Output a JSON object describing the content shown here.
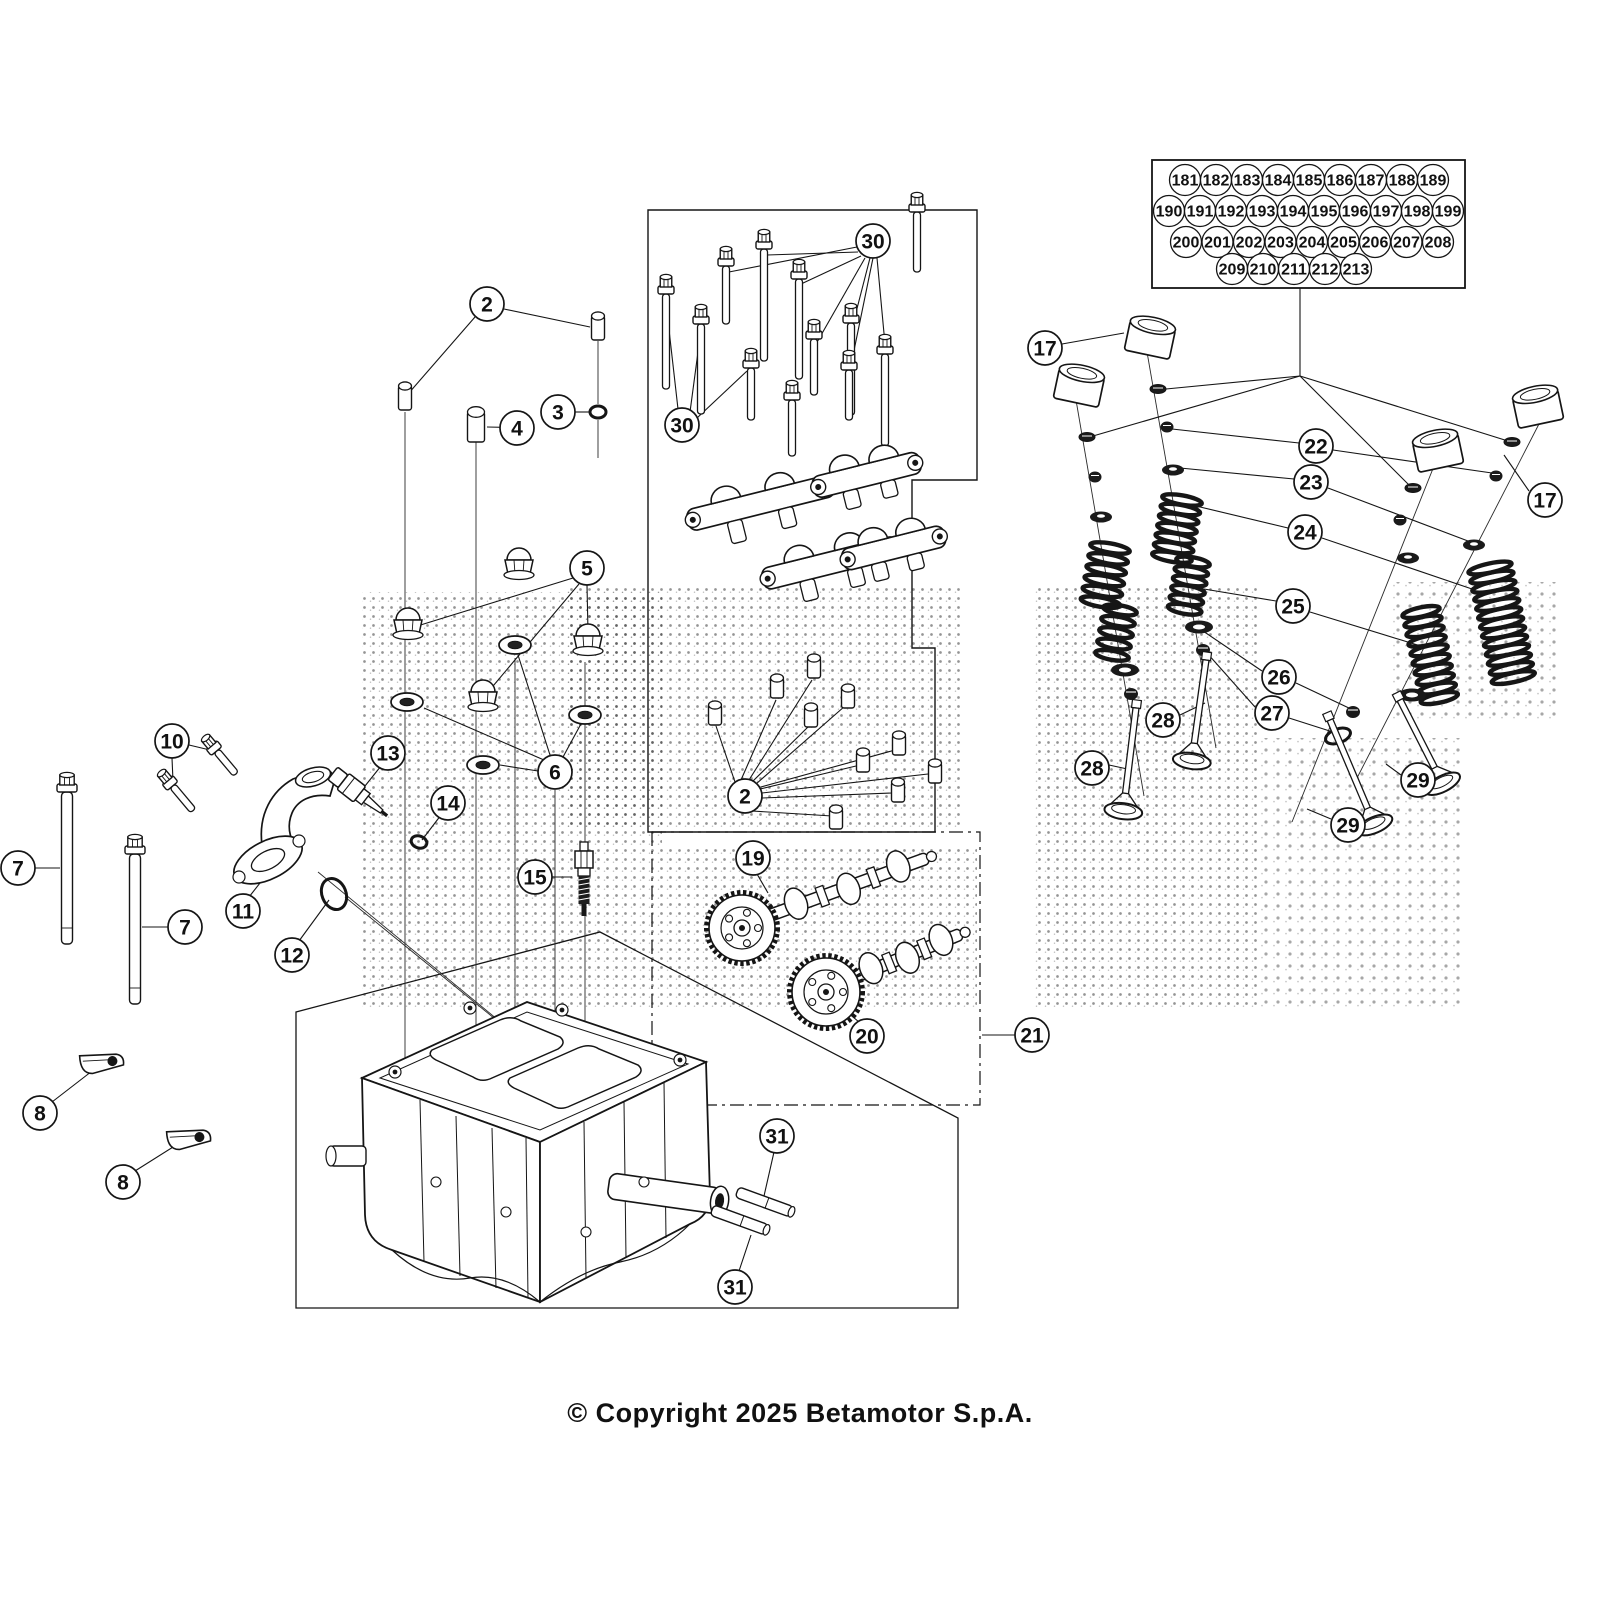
{
  "meta": {
    "copyright": "© Copyright 2025 Betamotor S.p.A."
  },
  "colors": {
    "ink": "#151515",
    "bg": "#ffffff",
    "dot": "#3c3c3c"
  },
  "grid_box": {
    "x": 1152,
    "y": 160,
    "w": 313,
    "h": 128,
    "rows": [
      {
        "y": 180,
        "x0": 1185,
        "step": 31,
        "labels": [
          "181",
          "182",
          "183",
          "184",
          "185",
          "186",
          "187",
          "188",
          "189"
        ]
      },
      {
        "y": 211,
        "x0": 1169,
        "step": 31,
        "labels": [
          "190",
          "191",
          "192",
          "193",
          "194",
          "195",
          "196",
          "197",
          "198",
          "199"
        ]
      },
      {
        "y": 242,
        "x0": 1186,
        "step": 31.5,
        "labels": [
          "200",
          "201",
          "202",
          "203",
          "204",
          "205",
          "206",
          "207",
          "208"
        ]
      },
      {
        "y": 269,
        "x0": 1232,
        "step": 31,
        "labels": [
          "209",
          "210",
          "211",
          "212",
          "213"
        ]
      }
    ],
    "leader_stem": [
      1300,
      288,
      1300,
      376
    ],
    "fan": [
      [
        1300,
        376,
        1166,
        389
      ],
      [
        1300,
        376,
        1093,
        436
      ],
      [
        1300,
        376,
        1508,
        441
      ],
      [
        1300,
        376,
        1410,
        486
      ]
    ]
  },
  "callouts": [
    {
      "label": "2",
      "x": 487,
      "y": 304
    },
    {
      "label": "2",
      "x": 745,
      "y": 796
    },
    {
      "label": "3",
      "x": 558,
      "y": 412
    },
    {
      "label": "4",
      "x": 517,
      "y": 428
    },
    {
      "label": "5",
      "x": 587,
      "y": 568
    },
    {
      "label": "6",
      "x": 555,
      "y": 772
    },
    {
      "label": "7",
      "x": 18,
      "y": 868
    },
    {
      "label": "7",
      "x": 185,
      "y": 927
    },
    {
      "label": "8",
      "x": 40,
      "y": 1113
    },
    {
      "label": "8",
      "x": 123,
      "y": 1182
    },
    {
      "label": "10",
      "x": 172,
      "y": 741
    },
    {
      "label": "11",
      "x": 243,
      "y": 911
    },
    {
      "label": "12",
      "x": 292,
      "y": 955
    },
    {
      "label": "13",
      "x": 388,
      "y": 753
    },
    {
      "label": "14",
      "x": 448,
      "y": 803
    },
    {
      "label": "15",
      "x": 535,
      "y": 877
    },
    {
      "label": "17",
      "x": 1045,
      "y": 348
    },
    {
      "label": "17",
      "x": 1545,
      "y": 500
    },
    {
      "label": "19",
      "x": 753,
      "y": 858
    },
    {
      "label": "20",
      "x": 867,
      "y": 1036
    },
    {
      "label": "21",
      "x": 1032,
      "y": 1035
    },
    {
      "label": "22",
      "x": 1316,
      "y": 446
    },
    {
      "label": "23",
      "x": 1311,
      "y": 482
    },
    {
      "label": "24",
      "x": 1305,
      "y": 532
    },
    {
      "label": "25",
      "x": 1293,
      "y": 606
    },
    {
      "label": "26",
      "x": 1279,
      "y": 677
    },
    {
      "label": "27",
      "x": 1272,
      "y": 713
    },
    {
      "label": "28",
      "x": 1163,
      "y": 720
    },
    {
      "label": "28",
      "x": 1092,
      "y": 768
    },
    {
      "label": "29",
      "x": 1418,
      "y": 780
    },
    {
      "label": "29",
      "x": 1348,
      "y": 825
    },
    {
      "label": "30",
      "x": 873,
      "y": 241
    },
    {
      "label": "30",
      "x": 682,
      "y": 425
    },
    {
      "label": "31",
      "x": 777,
      "y": 1136
    },
    {
      "label": "31",
      "x": 735,
      "y": 1287
    }
  ],
  "leaders": [
    [
      504,
      309,
      590,
      327
    ],
    [
      475,
      317,
      408,
      394
    ],
    [
      575,
      412,
      589,
      412
    ],
    [
      534,
      428,
      487,
      427
    ],
    [
      573,
      578,
      414,
      627
    ],
    [
      579,
      584,
      488,
      692
    ],
    [
      587,
      585,
      588,
      632
    ],
    [
      544,
      760,
      424,
      708
    ],
    [
      550,
      755,
      518,
      655
    ],
    [
      538,
      771,
      500,
      765
    ],
    [
      563,
      757,
      582,
      722
    ],
    [
      35,
      868,
      60,
      868
    ],
    [
      168,
      927,
      142,
      927
    ],
    [
      52,
      1102,
      96,
      1068
    ],
    [
      135,
      1171,
      181,
      1142
    ],
    [
      189,
      745,
      210,
      750
    ],
    [
      172,
      758,
      173,
      781
    ],
    [
      249,
      897,
      271,
      869
    ],
    [
      299,
      941,
      329,
      900
    ],
    [
      381,
      766,
      365,
      786
    ],
    [
      441,
      815,
      422,
      840
    ],
    [
      552,
      877,
      572,
      877
    ],
    [
      1062,
      344,
      1124,
      333
    ],
    [
      1529,
      491,
      1504,
      455
    ],
    [
      757,
      874,
      768,
      893
    ],
    [
      859,
      1022,
      841,
      1007
    ],
    [
      1015,
      1035,
      982,
      1035
    ],
    [
      1299,
      443,
      1172,
      429
    ],
    [
      1333,
      450,
      1492,
      473
    ],
    [
      1294,
      479,
      1180,
      468
    ],
    [
      1328,
      488,
      1468,
      541
    ],
    [
      1288,
      528,
      1196,
      506
    ],
    [
      1322,
      538,
      1472,
      589
    ],
    [
      1276,
      601,
      1198,
      588
    ],
    [
      1310,
      612,
      1424,
      647
    ],
    [
      1262,
      671,
      1203,
      631
    ],
    [
      1296,
      683,
      1351,
      709
    ],
    [
      1255,
      707,
      1207,
      653
    ],
    [
      1289,
      718,
      1336,
      733
    ],
    [
      1180,
      715,
      1205,
      703
    ],
    [
      1109,
      765,
      1132,
      770
    ],
    [
      1401,
      775,
      1386,
      764
    ],
    [
      1331,
      819,
      1307,
      809
    ],
    [
      857,
      247,
      729,
      272
    ],
    [
      858,
      252,
      767,
      255
    ],
    [
      861,
      256,
      801,
      284
    ],
    [
      865,
      258,
      816,
      344
    ],
    [
      870,
      258,
      852,
      328
    ],
    [
      877,
      258,
      886,
      355
    ],
    [
      873,
      258,
      850,
      370
    ],
    [
      678,
      409,
      667,
      312
    ],
    [
      690,
      412,
      700,
      337
    ],
    [
      697,
      418,
      747,
      371
    ],
    [
      774,
      1152,
      764,
      1196
    ],
    [
      739,
      1271,
      751,
      1235
    ],
    [
      735,
      782,
      716,
      726
    ],
    [
      741,
      780,
      776,
      700
    ],
    [
      749,
      780,
      812,
      680
    ],
    [
      752,
      782,
      809,
      726
    ],
    [
      756,
      784,
      845,
      706
    ],
    [
      760,
      789,
      856,
      766
    ],
    [
      761,
      787,
      895,
      750
    ],
    [
      762,
      793,
      928,
      774
    ],
    [
      762,
      798,
      892,
      793
    ],
    [
      752,
      811,
      832,
      816
    ]
  ],
  "axis_lines": [
    [
      1147,
      352,
      1216,
      748
    ],
    [
      1076,
      400,
      1144,
      796
    ],
    [
      1434,
      466,
      1292,
      822
    ],
    [
      1540,
      422,
      1357,
      778
    ],
    [
      318,
      872,
      520,
      1038
    ],
    [
      345,
      897,
      548,
      1062
    ]
  ],
  "construction_lines": [
    [
      405,
      412,
      405,
      1058
    ],
    [
      476,
      442,
      476,
      1086
    ],
    [
      515,
      658,
      515,
      1096
    ],
    [
      555,
      790,
      555,
      1106
    ],
    [
      585,
      662,
      585,
      1118
    ],
    [
      598,
      341,
      598,
      404
    ],
    [
      598,
      420,
      598,
      458
    ]
  ],
  "boxes": {
    "parts_box": "M648,832 L648,210 L977,210 L977,480 L912,480 L912,648 L935,648 L935,832 Z",
    "cam_box": {
      "x": 652,
      "y": 832,
      "w": 328,
      "h": 273
    },
    "tilt_box": "M296,1012 L600,932 L958,1118 L958,1308 L296,1308 Z"
  },
  "watermark_patches": [
    {
      "x": 362,
      "y": 592,
      "w": 300,
      "h": 418,
      "d": "a"
    },
    {
      "x": 565,
      "y": 585,
      "w": 395,
      "h": 245,
      "d": "a"
    },
    {
      "x": 662,
      "y": 848,
      "w": 315,
      "h": 160,
      "d": "a"
    },
    {
      "x": 1035,
      "y": 585,
      "w": 225,
      "h": 425,
      "d": "a"
    },
    {
      "x": 1258,
      "y": 738,
      "w": 205,
      "h": 272,
      "d": "b"
    },
    {
      "x": 1392,
      "y": 582,
      "w": 168,
      "h": 140,
      "d": "b"
    }
  ],
  "parts": [
    {
      "t": "head"
    },
    {
      "t": "stud",
      "x": 67,
      "y": 788,
      "len": 152
    },
    {
      "t": "stud",
      "x": 135,
      "y": 850,
      "len": 150
    },
    {
      "t": "boltang",
      "x": 214,
      "y": 748,
      "len": 30,
      "a": -40
    },
    {
      "t": "boltang",
      "x": 170,
      "y": 783,
      "len": 32,
      "a": -40
    },
    {
      "t": "guide",
      "x": 103,
      "y": 1060,
      "a": -12
    },
    {
      "t": "guide",
      "x": 190,
      "y": 1136,
      "a": -12
    },
    {
      "t": "elbow"
    },
    {
      "t": "oring",
      "x": 334,
      "y": 894,
      "rx": 12,
      "ry": 16,
      "a": -22
    },
    {
      "t": "sensor",
      "x": 358,
      "y": 793,
      "a": 38
    },
    {
      "t": "oring",
      "x": 419,
      "y": 842,
      "rx": 8,
      "ry": 6,
      "a": 18
    },
    {
      "t": "plug",
      "x": 584,
      "y": 842
    },
    {
      "t": "dowel",
      "x": 405,
      "y": 386,
      "w": 13,
      "h": 24
    },
    {
      "t": "dowel",
      "x": 598,
      "y": 316,
      "w": 13,
      "h": 24
    },
    {
      "t": "oring",
      "x": 598,
      "y": 412,
      "rx": 8,
      "ry": 6,
      "a": 0
    },
    {
      "t": "dowel",
      "x": 476,
      "y": 412,
      "w": 17,
      "h": 30
    },
    {
      "t": "acorn",
      "x": 408,
      "y": 608
    },
    {
      "t": "acorn",
      "x": 519,
      "y": 548
    },
    {
      "t": "acorn",
      "x": 588,
      "y": 624
    },
    {
      "t": "acorn",
      "x": 483,
      "y": 680
    },
    {
      "t": "washer",
      "x": 407,
      "y": 702
    },
    {
      "t": "washer",
      "x": 515,
      "y": 645
    },
    {
      "t": "washer",
      "x": 585,
      "y": 715
    },
    {
      "t": "washer",
      "x": 483,
      "y": 765
    },
    {
      "t": "bolt",
      "x": 666,
      "y": 290,
      "len": 95
    },
    {
      "t": "bolt",
      "x": 701,
      "y": 320,
      "len": 90
    },
    {
      "t": "bolt",
      "x": 726,
      "y": 262,
      "len": 58
    },
    {
      "t": "bolt",
      "x": 764,
      "y": 245,
      "len": 112
    },
    {
      "t": "bolt",
      "x": 799,
      "y": 275,
      "len": 100
    },
    {
      "t": "bolt",
      "x": 751,
      "y": 364,
      "len": 52
    },
    {
      "t": "bolt",
      "x": 792,
      "y": 396,
      "len": 56
    },
    {
      "t": "bolt",
      "x": 814,
      "y": 335,
      "len": 56
    },
    {
      "t": "bolt",
      "x": 851,
      "y": 319,
      "len": 92
    },
    {
      "t": "bolt",
      "x": 849,
      "y": 366,
      "len": 50
    },
    {
      "t": "bolt",
      "x": 885,
      "y": 350,
      "len": 92
    },
    {
      "t": "bolt",
      "x": 917,
      "y": 208,
      "len": 60
    },
    {
      "t": "dowel",
      "x": 715,
      "y": 705,
      "w": 13,
      "h": 20
    },
    {
      "t": "dowel",
      "x": 777,
      "y": 678,
      "w": 13,
      "h": 20
    },
    {
      "t": "dowel",
      "x": 814,
      "y": 658,
      "w": 13,
      "h": 20
    },
    {
      "t": "dowel",
      "x": 811,
      "y": 707,
      "w": 13,
      "h": 20
    },
    {
      "t": "dowel",
      "x": 848,
      "y": 688,
      "w": 13,
      "h": 20
    },
    {
      "t": "dowel",
      "x": 863,
      "y": 752,
      "w": 13,
      "h": 20
    },
    {
      "t": "dowel",
      "x": 899,
      "y": 735,
      "w": 13,
      "h": 20
    },
    {
      "t": "dowel",
      "x": 935,
      "y": 763,
      "w": 13,
      "h": 20
    },
    {
      "t": "dowel",
      "x": 898,
      "y": 782,
      "w": 13,
      "h": 20
    },
    {
      "t": "dowel",
      "x": 836,
      "y": 809,
      "w": 13,
      "h": 20
    },
    {
      "t": "rocker",
      "x": 760,
      "y": 500,
      "w": 150,
      "h": 58,
      "a": -14
    },
    {
      "t": "rocker",
      "x": 866,
      "y": 472,
      "w": 110,
      "h": 48,
      "a": -14
    },
    {
      "t": "rocker",
      "x": 830,
      "y": 560,
      "w": 140,
      "h": 54,
      "a": -14
    },
    {
      "t": "rocker",
      "x": 893,
      "y": 545,
      "w": 105,
      "h": 46,
      "a": -14
    },
    {
      "t": "cam",
      "x": 768,
      "y": 916,
      "len": 170,
      "a": -20
    },
    {
      "t": "gear",
      "x": 742,
      "y": 928,
      "r": 33
    },
    {
      "t": "cam",
      "x": 852,
      "y": 978,
      "len": 118,
      "a": -22
    },
    {
      "t": "gear",
      "x": 826,
      "y": 992,
      "r": 34
    },
    {
      "t": "bucket",
      "x": 1150,
      "y": 339,
      "a": 12
    },
    {
      "t": "bucket",
      "x": 1079,
      "y": 387,
      "a": 12
    },
    {
      "t": "bucket",
      "x": 1438,
      "y": 452,
      "a": -12
    },
    {
      "t": "bucket",
      "x": 1538,
      "y": 408,
      "a": -12
    },
    {
      "t": "shim",
      "x": 1158,
      "y": 389
    },
    {
      "t": "shim",
      "x": 1087,
      "y": 437
    },
    {
      "t": "shim",
      "x": 1512,
      "y": 442
    },
    {
      "t": "shim",
      "x": 1413,
      "y": 488
    },
    {
      "t": "bead",
      "x": 1167,
      "y": 427
    },
    {
      "t": "bead",
      "x": 1095,
      "y": 477
    },
    {
      "t": "bead",
      "x": 1496,
      "y": 476
    },
    {
      "t": "bead",
      "x": 1400,
      "y": 520
    },
    {
      "t": "ret",
      "x": 1173,
      "y": 470
    },
    {
      "t": "ret",
      "x": 1101,
      "y": 517
    },
    {
      "t": "ret",
      "x": 1474,
      "y": 545
    },
    {
      "t": "ret",
      "x": 1408,
      "y": 558
    },
    {
      "t": "spring",
      "x": 1182,
      "y": 500,
      "len": 58,
      "w": 40,
      "a": 10
    },
    {
      "t": "spring",
      "x": 1110,
      "y": 548,
      "len": 55,
      "w": 40,
      "a": 10
    },
    {
      "t": "spring",
      "x": 1490,
      "y": 568,
      "len": 112,
      "w": 44,
      "a": -12
    },
    {
      "t": "spring",
      "x": 1193,
      "y": 562,
      "len": 48,
      "w": 34,
      "a": 10
    },
    {
      "t": "spring",
      "x": 1120,
      "y": 610,
      "len": 46,
      "w": 34,
      "a": 10
    },
    {
      "t": "spring",
      "x": 1421,
      "y": 612,
      "len": 88,
      "w": 38,
      "a": -12
    },
    {
      "t": "seat",
      "x": 1199,
      "y": 627
    },
    {
      "t": "seat",
      "x": 1125,
      "y": 670
    },
    {
      "t": "seat",
      "x": 1412,
      "y": 695
    },
    {
      "t": "seal",
      "x": 1203,
      "y": 650
    },
    {
      "t": "seal",
      "x": 1131,
      "y": 694
    },
    {
      "t": "seal",
      "x": 1353,
      "y": 712
    },
    {
      "t": "oring",
      "x": 1338,
      "y": 736,
      "rx": 13,
      "ry": 7,
      "a": -20
    },
    {
      "t": "valve",
      "x": 1206,
      "y": 660,
      "a": 8,
      "len": 84
    },
    {
      "t": "valve",
      "x": 1136,
      "y": 708,
      "a": 7,
      "len": 86
    },
    {
      "t": "valve",
      "x": 1330,
      "y": 720,
      "a": -23,
      "len": 96
    },
    {
      "t": "valve",
      "x": 1400,
      "y": 700,
      "a": -27,
      "len": 76
    },
    {
      "t": "pin",
      "x": 737,
      "y": 1192,
      "len": 58,
      "a": 20
    },
    {
      "t": "pin",
      "x": 712,
      "y": 1210,
      "len": 58,
      "a": 20
    }
  ]
}
